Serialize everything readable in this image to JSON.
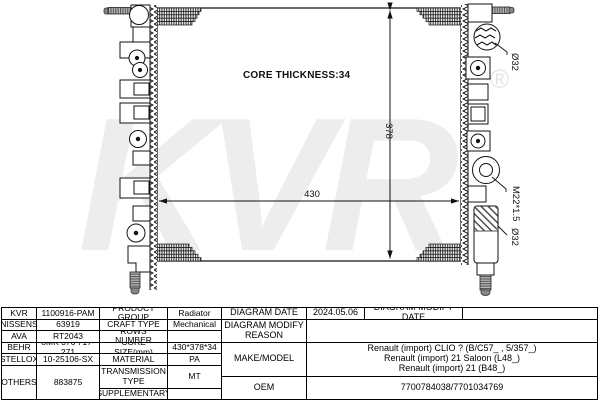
{
  "diagram": {
    "watermark": "KVR",
    "registered_mark": "®",
    "core_thickness_label": "CORE THICKNESS:34",
    "height_dim": "378",
    "width_dim": "430",
    "top_port_label": "Ø32",
    "drain_plug_label": "M22*1.5",
    "bottom_port_label": "Ø32"
  },
  "table": {
    "left": {
      "rows": [
        {
          "brand": "KVR",
          "number": "1100916-PAM",
          "property": "PRODUCT GROUP",
          "value": "Radiator"
        },
        {
          "brand": "NISSENS",
          "number": "63919",
          "property": "CRAFT TYPE",
          "value": "Mechanical"
        },
        {
          "brand": "AVA",
          "number": "RT2043",
          "property": "ROWS NUMBER",
          "value": ""
        },
        {
          "brand": "BEHR",
          "number": "8MK 376 717-271",
          "property": "CORE SIZE(mm)",
          "value": "430*378*34"
        },
        {
          "brand": "STELLOX",
          "number": "10-25106-SX",
          "property": "MATERIAL",
          "value": "PA"
        },
        {
          "brand": "OTHERS",
          "number": "883875",
          "property": "TRANSMISSION TYPE",
          "value": "MT"
        },
        {
          "property": "SUPPLEMENTARY",
          "value": ""
        }
      ]
    },
    "right": {
      "diagram_date_label": "DIAGRAM DATE",
      "diagram_date": "2024.05.06",
      "diagram_modify_date_label": "DIAGRAM MODIFY DATE",
      "diagram_modify_date": "",
      "diagram_modify_reason_label": "DIAGRAM MODIFY REASON",
      "diagram_modify_reason": "",
      "make_model_label": "MAKE/MODEL",
      "make_model_lines": [
        "Renault (import) CLIO ? (B/C57_ , 5/357_)",
        "Renault (import) 21 Saloon (L48_)",
        "Renault (import) 21 (B48_)"
      ],
      "oem_label": "OEM",
      "oem_value": "7700784038/7701034769"
    }
  }
}
